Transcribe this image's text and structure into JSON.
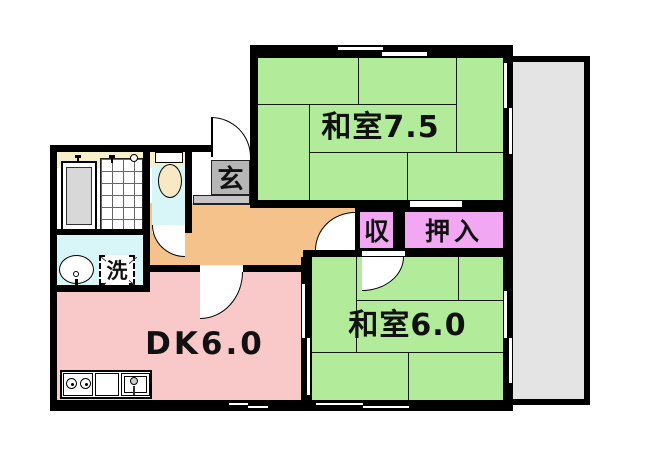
{
  "plan": {
    "title": "apartment floor plan",
    "rooms": {
      "washitsu_7_5": "和室7.5",
      "washitsu_6_0": "和室6.0",
      "dining_kitchen": "DK6.0",
      "genkan": "玄",
      "storage": "収",
      "oshiire": "押入",
      "laundry": "洗"
    },
    "colors": {
      "tatami_green": "#b2eb9a",
      "dk_pink": "#f9c9c9",
      "hall_orange": "#f6c28b",
      "closet_violet": "#f2a7f3",
      "sanitary_cyan": "#d8f6f8",
      "genkan_gray": "#b6b6b6",
      "step_gray": "#c6c6c6",
      "balcony_gray": "#e4e4e4",
      "bath_cream": "#f8efcb",
      "toilet_cream": "#f7e9c4",
      "tub_gray": "#d8d8d8",
      "wall_black": "#000000"
    }
  }
}
